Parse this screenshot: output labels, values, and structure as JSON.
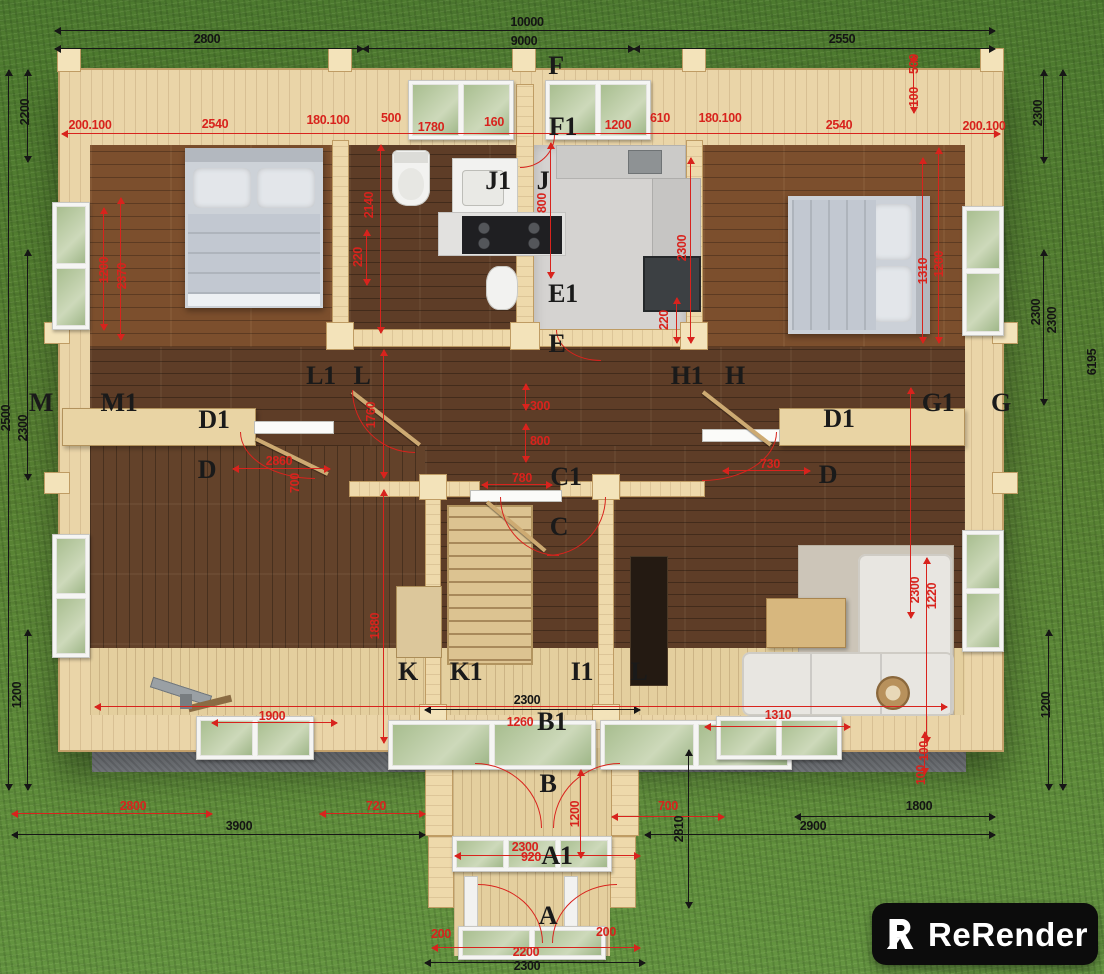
{
  "watermark": {
    "brand": "ReRender",
    "logo_icon": "rerender-logo"
  },
  "colors": {
    "grass": "#567f31",
    "wall_wood": "#ead5a8",
    "floor_dark": "#5e3d27",
    "floor_mid": "#7c4f2d",
    "deck": "#e4cf9e",
    "kitchen_floor": "#d5d3d1",
    "dim_red": "#d8231d",
    "dim_black": "#161616",
    "foundation": "#8e9297",
    "logo_bg": "#0c0c0c",
    "logo_text": "#ffffff"
  },
  "labels": [
    {
      "t": "10000",
      "x": 527,
      "y": 22,
      "k": "b"
    },
    {
      "t": "2800",
      "x": 207,
      "y": 39,
      "k": "b"
    },
    {
      "t": "9000",
      "x": 524,
      "y": 41,
      "k": "b"
    },
    {
      "t": "2550",
      "x": 842,
      "y": 39,
      "k": "b"
    },
    {
      "t": "200.100",
      "x": 90,
      "y": 125,
      "k": "r"
    },
    {
      "t": "2540",
      "x": 215,
      "y": 124,
      "k": "r"
    },
    {
      "t": "180.100",
      "x": 328,
      "y": 120,
      "k": "r"
    },
    {
      "t": "500",
      "x": 391,
      "y": 118,
      "k": "r"
    },
    {
      "t": "1780",
      "x": 431,
      "y": 127,
      "k": "r"
    },
    {
      "t": "160",
      "x": 494,
      "y": 122,
      "k": "r"
    },
    {
      "t": "1200",
      "x": 618,
      "y": 125,
      "k": "r"
    },
    {
      "t": "610",
      "x": 660,
      "y": 118,
      "k": "r"
    },
    {
      "t": "180.100",
      "x": 720,
      "y": 118,
      "k": "r"
    },
    {
      "t": "2540",
      "x": 839,
      "y": 125,
      "k": "r"
    },
    {
      "t": "200.100",
      "x": 984,
      "y": 126,
      "k": "r"
    },
    {
      "t": "500",
      "x": 914,
      "y": 64,
      "k": "rv"
    },
    {
      "t": "100",
      "x": 914,
      "y": 97,
      "k": "rv"
    },
    {
      "t": "2200",
      "x": 25,
      "y": 112,
      "k": "bv"
    },
    {
      "t": "2500",
      "x": 6,
      "y": 418,
      "k": "bv"
    },
    {
      "t": "2300",
      "x": 23,
      "y": 428,
      "k": "bv"
    },
    {
      "t": "1200",
      "x": 17,
      "y": 695,
      "k": "bv"
    },
    {
      "t": "1200",
      "x": 104,
      "y": 270,
      "k": "rv"
    },
    {
      "t": "2370",
      "x": 122,
      "y": 276,
      "k": "rv"
    },
    {
      "t": "2140",
      "x": 369,
      "y": 205,
      "k": "rv"
    },
    {
      "t": "220",
      "x": 358,
      "y": 257,
      "k": "rv"
    },
    {
      "t": "800",
      "x": 542,
      "y": 203,
      "k": "rv"
    },
    {
      "t": "2300",
      "x": 682,
      "y": 248,
      "k": "rv"
    },
    {
      "t": "220",
      "x": 664,
      "y": 320,
      "k": "rv"
    },
    {
      "t": "1310",
      "x": 923,
      "y": 271,
      "k": "rv"
    },
    {
      "t": "1200",
      "x": 939,
      "y": 264,
      "k": "rv"
    },
    {
      "t": "2300",
      "x": 1038,
      "y": 113,
      "k": "bv"
    },
    {
      "t": "2300",
      "x": 1036,
      "y": 312,
      "k": "bv"
    },
    {
      "t": "2300",
      "x": 1052,
      "y": 320,
      "k": "bv"
    },
    {
      "t": "6195",
      "x": 1092,
      "y": 362,
      "k": "bv"
    },
    {
      "t": "1200",
      "x": 1046,
      "y": 705,
      "k": "bv"
    },
    {
      "t": "300",
      "x": 540,
      "y": 406,
      "k": "r"
    },
    {
      "t": "800",
      "x": 540,
      "y": 441,
      "k": "r"
    },
    {
      "t": "780",
      "x": 522,
      "y": 478,
      "k": "r"
    },
    {
      "t": "730",
      "x": 770,
      "y": 464,
      "k": "r"
    },
    {
      "t": "2860",
      "x": 279,
      "y": 461,
      "k": "r"
    },
    {
      "t": "700",
      "x": 295,
      "y": 483,
      "k": "rv"
    },
    {
      "t": "1760",
      "x": 371,
      "y": 415,
      "k": "rv"
    },
    {
      "t": "1880",
      "x": 375,
      "y": 626,
      "k": "rv"
    },
    {
      "t": "2300",
      "x": 915,
      "y": 590,
      "k": "rv"
    },
    {
      "t": "1220",
      "x": 932,
      "y": 596,
      "k": "rv"
    },
    {
      "t": "1900",
      "x": 272,
      "y": 716,
      "k": "r"
    },
    {
      "t": "2300",
      "x": 527,
      "y": 700,
      "k": "b"
    },
    {
      "t": "1260",
      "x": 520,
      "y": 722,
      "k": "r"
    },
    {
      "t": "1310",
      "x": 778,
      "y": 715,
      "k": "r"
    },
    {
      "t": "100",
      "x": 924,
      "y": 751,
      "k": "rv"
    },
    {
      "t": "100",
      "x": 921,
      "y": 775,
      "k": "rv"
    },
    {
      "t": "2800",
      "x": 133,
      "y": 806,
      "k": "r"
    },
    {
      "t": "3900",
      "x": 239,
      "y": 826,
      "k": "b"
    },
    {
      "t": "720",
      "x": 376,
      "y": 806,
      "k": "r"
    },
    {
      "t": "700",
      "x": 668,
      "y": 806,
      "k": "r"
    },
    {
      "t": "2810",
      "x": 679,
      "y": 829,
      "k": "bv"
    },
    {
      "t": "1800",
      "x": 919,
      "y": 806,
      "k": "b"
    },
    {
      "t": "2900",
      "x": 813,
      "y": 826,
      "k": "b"
    },
    {
      "t": "1200",
      "x": 575,
      "y": 814,
      "k": "rv"
    },
    {
      "t": "2300",
      "x": 525,
      "y": 847,
      "k": "r"
    },
    {
      "t": "920",
      "x": 531,
      "y": 857,
      "k": "r"
    },
    {
      "t": "200",
      "x": 441,
      "y": 934,
      "k": "r"
    },
    {
      "t": "200",
      "x": 606,
      "y": 932,
      "k": "r"
    },
    {
      "t": "2200",
      "x": 526,
      "y": 952,
      "k": "r"
    },
    {
      "t": "2300",
      "x": 527,
      "y": 966,
      "k": "b"
    },
    {
      "t": "F",
      "x": 556,
      "y": 66,
      "k": "s"
    },
    {
      "t": "F1",
      "x": 563,
      "y": 127,
      "k": "s"
    },
    {
      "t": "J1",
      "x": 498,
      "y": 181,
      "k": "s"
    },
    {
      "t": "J",
      "x": 543,
      "y": 181,
      "k": "s"
    },
    {
      "t": "E1",
      "x": 563,
      "y": 294,
      "k": "s"
    },
    {
      "t": "E",
      "x": 557,
      "y": 344,
      "k": "s"
    },
    {
      "t": "M",
      "x": 41,
      "y": 403,
      "k": "s"
    },
    {
      "t": "M1",
      "x": 119,
      "y": 403,
      "k": "s"
    },
    {
      "t": "L1",
      "x": 321,
      "y": 376,
      "k": "s"
    },
    {
      "t": "L",
      "x": 362,
      "y": 376,
      "k": "s"
    },
    {
      "t": "H1",
      "x": 687,
      "y": 376,
      "k": "s"
    },
    {
      "t": "H",
      "x": 735,
      "y": 376,
      "k": "s"
    },
    {
      "t": "G1",
      "x": 938,
      "y": 403,
      "k": "s"
    },
    {
      "t": "G",
      "x": 1001,
      "y": 403,
      "k": "s"
    },
    {
      "t": "D1",
      "x": 214,
      "y": 420,
      "k": "s"
    },
    {
      "t": "D",
      "x": 207,
      "y": 470,
      "k": "s"
    },
    {
      "t": "D1",
      "x": 839,
      "y": 419,
      "k": "s"
    },
    {
      "t": "D",
      "x": 828,
      "y": 475,
      "k": "s"
    },
    {
      "t": "C1",
      "x": 566,
      "y": 477,
      "k": "s"
    },
    {
      "t": "C",
      "x": 559,
      "y": 527,
      "k": "s"
    },
    {
      "t": "K",
      "x": 408,
      "y": 672,
      "k": "s"
    },
    {
      "t": "K1",
      "x": 466,
      "y": 672,
      "k": "s"
    },
    {
      "t": "I1",
      "x": 582,
      "y": 672,
      "k": "s"
    },
    {
      "t": "L",
      "x": 639,
      "y": 672,
      "k": "s"
    },
    {
      "t": "B1",
      "x": 552,
      "y": 722,
      "k": "s"
    },
    {
      "t": "B",
      "x": 548,
      "y": 784,
      "k": "s"
    },
    {
      "t": "A1",
      "x": 557,
      "y": 856,
      "k": "s"
    },
    {
      "t": "A",
      "x": 548,
      "y": 916,
      "k": "s"
    }
  ]
}
